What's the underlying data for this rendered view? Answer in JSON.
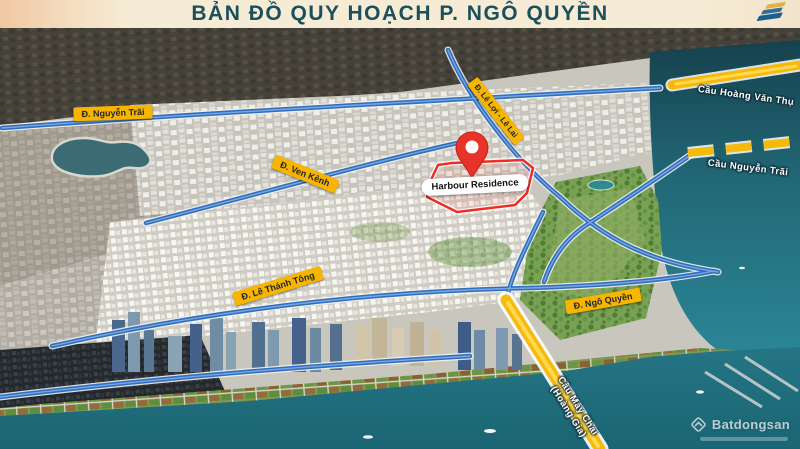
{
  "header": {
    "title": "BẢN ĐỒ QUY HOẠCH P. NGÔ QUYỀN"
  },
  "map": {
    "road_labels": {
      "nguyen_trai": "Đ. Nguyễn Trãi",
      "ven_kenh": "Đ. Ven Kênh",
      "le_loi_le_lai": "Đ. Lê Lợi - Lê Lai",
      "le_thanh_tong": "Đ. Lê Thánh Tông",
      "ngo_quyen": "Đ. Ngô Quyền"
    },
    "bridge_labels": {
      "hoang_van_thu": "Cầu Hoàng Văn Thụ",
      "nguyen_trai": "Cầu Nguyễn Trãi",
      "may_chai_line1": "Cầu Máy Chai",
      "may_chai_line2": "(Hoàng Gia)"
    },
    "site": {
      "name": "Harbour Residence"
    },
    "watermark": {
      "brand": "Batdongsan"
    },
    "colors": {
      "badge": "#F7B500",
      "pin": "#E8332A",
      "road": "#2F6FC0",
      "bridge": "#F6B90C",
      "water": "#1E6F7E",
      "title": "#1B4F5C"
    }
  }
}
